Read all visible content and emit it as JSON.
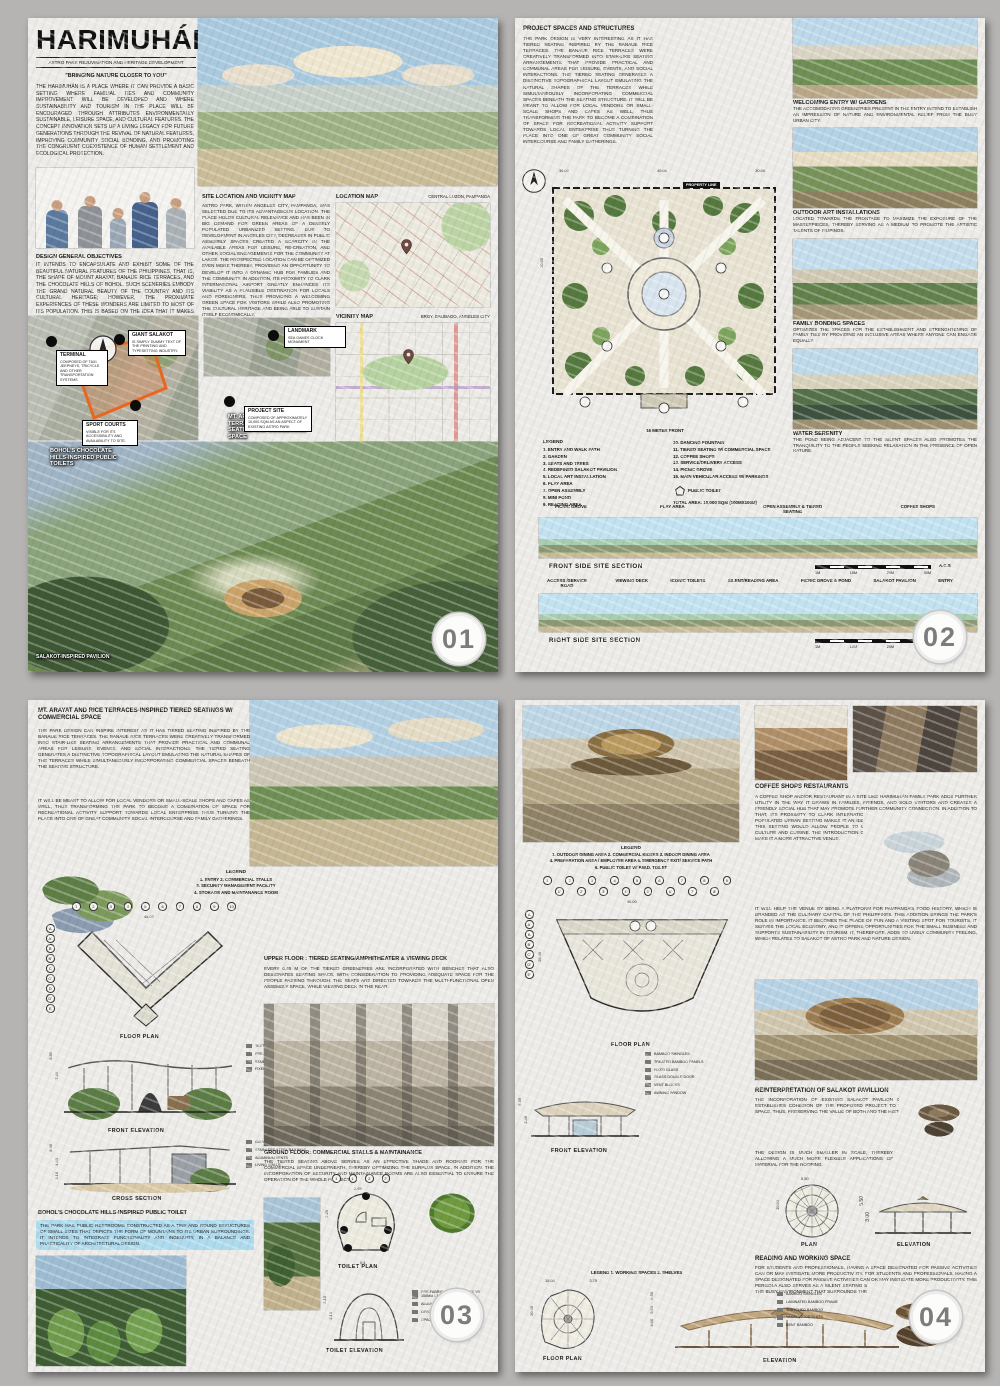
{
  "panel1": {
    "badge": "01",
    "title": "HARIMUHÁN",
    "subtitle": "ASTRO PARK REJUVINATION AND HERITAGE DEVELOPMENT",
    "tagline": "\"BRINGING NATURE CLOSER TO YOU\"",
    "intro": "THE HARIMUHÁN IS A PLACE WHERE IT CAN PROVIDE A BASIC SETTING WHERE FAMILIAL TIES AND COMMUNITY IMPROVEMENT WILL BE DEVELOPED AND WHERE SUSTAINABILITY AND TOURISM IN THE PLACE WILL BE ENCOURAGED THROUGH ATTRIBUTES ENVIRONMENTALLY SUSTAINABLE, LEISURE SPACE, AND CULTURAL FEATURES. THE CONCEPT INNOVATION SETS UP A LIVING LEGACY FOR FUTURE GENERATIONS THROUGH THE REVIVAL OF NATURAL FEATURES, IMPROVING COMMUNITY SOCIAL BONDING, AND PROMOTING THE CONGRUENT COEXISTENCE OF HUMAN SETTLEMENT AND ECOLOGICAL PROTECTION.",
    "objectives_heading": "DESIGN GENERAL OBJECTIVES",
    "objectives": "IT INTENDS TO ENCAPSULATE AND EXHIBIT SOME OF THE BEAUTIFUL NATURAL FEATURES OF THE PHILIPPINES, THAT IS, THE SHAPE OF MOUNT ARAYAT, BANAUE RICE TERRACES, AND THE CHOCOLATE HILLS OF BOHOL. SUCH SCENERIES EMBODY THE GRAND NATURAL BEAUTY OF THE COUNTRY AND ITS CULTURAL HERITAGE; HOWEVER, THE PROXIMATE EXPERIENCES OF THESE WONDERS ARE LIMITED TO MOST OF ITS POPULATION. THIS IS BASED ON THE IDEA THAT IT MAKES THESE UNIQUE CHARACTERISTICS ACCESSIBLE TO THE COMMUNITY SO AS TO ESTABLISH AN ENVIRONMENT EMBODYING THE UNIQUE FORMS AND NATURAL",
    "site_heading": "SITE LOCATION AND VICINITY MAP",
    "site_text": "ASTRO PARK, WITHIN ANGELES CITY, PAMPANGA, WAS SELECTED DUE TO ITS ADVANTAGEOUS LOCATION. THE PLACE HOLDS CULTURAL RELEVANCE AND HAS BEEN IN BIG DEMAND FOR GREEN AREAS OF A DENSELY POPULATED URBANIZED SETTING. DUE TO DEVELOPMENT IN ANGELES CITY, DECREASES IN PUBLIC ASSEMBLY SPACES CREATED A SCARCITY IN THE AVAILABLE AREAS FOR LEISURE, RE-CREATION, AND OTHER SOCIAL ENGAGEMENTS FOR THE COMMUNITY AT LARGE. THE PROSPECTED LOCATION CAN BE OPTIMIZED EVEN MORE THEREBY, PROVIDING AN OPPORTUNITY TO DEVELOP IT INTO A DYNAMIC HUB FOR FAMILIES AND THE COMMUNITY. IN ADDITION, ITS PROXIMITY TO CLARK INTERNATIONAL AIRPORT GREATLY ENHANCES ITS VIABILITY AS A PLAUSIBLE DESTINATION FOR LOCALS AND FOREIGNERS, THUS PROVIDING A WELCOMING GREEN SPACE FOR VISITORS WHILE ALSO PROMOTING THE CULTURAL HERITAGE AND BEING ABLE TO SUSTAIN ITSELF ECONOMICALLY.",
    "location_map_label": "LOCATION MAP",
    "location_map_value": "CENTRAL LUZON, PAMPANGA",
    "vicinity_map_label": "VICINITY MAP",
    "vicinity_map_value": "BRGY. BALIBAGO, ANGELES CITY",
    "callouts": {
      "landmark": {
        "t": "LANDMARK",
        "d": "SEA GAMES CLOCK MONUMENT"
      },
      "giant_salakot": {
        "t": "GIANT SALAKOT",
        "d": "IS SIMPLY DUMMY TEXT OF THE PRINTING AND TYPESETTING INDUSTRY."
      },
      "terminal": {
        "t": "TERMINAL",
        "d": "COMPOSED OF TAXI, JEEPNEYS, TRICYCLE AND OTHER TRANSPORTATION SYSTEMS"
      },
      "project_site": {
        "t": "PROJECT SITE",
        "d": "COMPOSED OF APPROXIMATELY 10,000 SQM AS AN ASPECT OF EXISTING ASTRO PARK"
      },
      "sport_courts": {
        "t": "SPORT COURTS",
        "d": "VISIBLE FOR ITS ACCESSIBILITY AND AVAILABILITY TO SITE."
      }
    },
    "overlay_labels": {
      "seating": "MT. ARAYAT AND RICE TERRACES-INSPIRED SEATING AND COMMERCIAL SPACE",
      "toilets": "BOHOL'S CHOCOLATE HILLS-INSPIRED PUBLIC TOILETS",
      "pavilion": "SALAKOT-INSPIRED PAVILION"
    }
  },
  "panel2": {
    "badge": "02",
    "heading": "PROJECT SPACES AND STRUCTURES",
    "body": "THE PARK DESIGN IS VERY INTERESTING AS IT HAS TIERED SEATING INSPIRED BY THE BANAUE RICE TERRACES. THE BANAUE RICE TERRACES WERE CREATIVELY TRANSFORMED INTO STAIR-LIKE SEATING ARRANGEMENTS THAT PROVIDE PRACTICAL AND COMMUNAL AREAS FOR LEISURE, EVENTS, AND SOCIAL INTERACTIONS. THE TIERED SEATING GENERATES A DISTINCTIVE TOPOGRAPHICAL LAYOUT EMULATING THE NATURAL SHAPES OF THE TERRACES WHILE SIMULTANEOUSLY INCORPORATING COMMERCIAL SPACES BENEATH THE SEATING STRUCTURE. IT WILL BE MEANT TO ALLOW FOR LOCAL VENDORS OR SMALL-SCALE SHOPS AND CAFES AS WELL, THUS TRANSFORMING THE PARK TO BECOME A COMBINATION OF SPACE FOR RECREATIONAL ACTIVITY SUPPORT TOWARDS LOCAL ENTERPRISE THUS TURNING THE PLACE INTO ONE OF GREAT COMMUNITY SOCIAL INTERCOURSE AND FAMILY GATHERINGS.",
    "property_line": "PROPERTY LINE",
    "dims_top": [
      "30.00",
      "40.00",
      "30.00"
    ],
    "dim_left": "20.00",
    "frontage": "16 METER FRONT",
    "legend_title": "LEGEND",
    "legend_col1": [
      "1. ENTRY AND WALK PATH",
      "2. GARDEN",
      "3. SEATS AND TREES",
      "4. REDEFINED SALAKOT PAVILION",
      "5. LOCAL ART INSTALLATION",
      "6. PLAY AREA",
      "7. OPEN ASSEMBLY",
      "8. MINI POND",
      "9. READING AREA"
    ],
    "legend_col2": [
      "10. DANCING FOUNTAIN",
      "11. TIERED SEATING W/ COMMERCIAL SPACE",
      "12. COFFEE SHOPS",
      "13. SERVICE/DELIVERY ACCESS",
      "14. PICNIC GROVE",
      "15. MAIN VEHICULAR ACCESS W/ PARKINGS"
    ],
    "legend_toilet": "PUBLIC TOILET",
    "total_area": "TOTAL AREA: 10,000 SQM (100MX100M)",
    "captions": [
      {
        "t": "WELCOMING ENTRY W/ GARDENS",
        "d": "THE ACCOMODATING GREENERIES PRESENT IN THE ENTRY INTEND TO ESTABLISH AN IMPRESSION OF NATURE AND ENVIRONMENTAL RELIEF FROM THE BUSY URBAN CITY."
      },
      {
        "t": "OUTDOOR ART INSTALLATIONS",
        "d": "LOCATED TOWARDS THE FRONTAGE TO MAXIMIZE THE EXPOSURE OF THE MASTERPIECES, THEREBY SERVING AS A MEDIUM TO PROMOTE THE ARTISTIC TALENTS OF FILIPINOS."
      },
      {
        "t": "FAMILY BONDING SPACES",
        "d": "OPTIMIZES THE SPACES FOR THE ESTABLISHMENT AND STRENGHTENING OF FAMILY TIES BY PROVIDING AN INCLUSIVE AREAS WHERE ANYONE CAN ENGAGE EQUALLY."
      },
      {
        "t": "WATER SERENITY",
        "d": "THE POND BEING ADJACENT TO THE SILENT SPACES ALSO PROMOTES THE TRANQUILITY TO THE PEOPLE SEEKING RELAXATION IN THE PRESENCE OF OPEN NATURE."
      }
    ],
    "front_section_labels": [
      "PICNIC GROVE",
      "PLAY AREA",
      "OPEN ASSEMBLY & TIERED SEATING",
      "COFFEE SHOPS"
    ],
    "front_section_caption": "FRONT SIDE SITE SECTION",
    "right_section_labels": [
      "ACCESS /SERVICE ROAD",
      "VIEWING DECK",
      "ICONIC TOILETS",
      "SILENT/READING AREA",
      "PICNIC GROVE & POND",
      "SALAKOT PAVILION",
      "ENTRY"
    ],
    "right_section_caption": "RIGHT SIDE SITE SECTION",
    "scale_labels": [
      "1M",
      "10M",
      "20M",
      "30M"
    ],
    "scale_suffix": "A.C.S"
  },
  "panel3": {
    "badge": "03",
    "heading": "MT. ARAYAT AND RICE TERRACES-INSPIRED TIERED SEATINGS W/ COMMERCIAL SPACE",
    "para1": "THE PARK DESIGN CAN INSPIRE INTEREST AS IT HAS TIERED SEATING INSPIRED BY THE BANAUE RICE TERRACES. THE BANAUE RICE TERRACES WERE CREATIVELY TRANSFORMED INTO STAIR-LIKE SEATING ARRANGEMENTS THAT PROVIDE PRACTICAL AND COMMUNAL AREAS FOR LEISURE, EVENTS, AND SOCIAL INTERACTIONS. THE TIERED SEATING GENERATES A DISTINCTIVE TOPOGRAPHICAL LAYOUT EMULATING THE NATURAL SHAPES OF THE TERRACES WHILE SIMULTANEOUSLY INCORPORATING COMMERCIAL SPACES BENEATH THE SEATING STRUCTURE.",
    "para2": "IT WILL BE MEANT TO ALLOW FOR LOCAL VENDORS OR SMALL-SCALE SHOPS AND CAFES AS WELL, THUS TRANSFORMING THE PARK TO BECOME A COMBINATION OF SPACE FOR RECREATIONAL ACTIVITY SUPPORT TOWARDS LOCAL ENTERPRISE THUS TURNING THE PLACE INTO ONE OF GREAT COMMUNITY SOCIAL INTERCOURSE AND FAMILY GATHERINGS.",
    "legend_title": "LEGEND",
    "legend_lines": [
      "1. ENTRY    2. COMMERCIAL STALLS",
      "3. SECURITY MANAGEMENT FACILITY",
      "4. STORAGE AND MAINTANANCE ROOM"
    ],
    "grid_top": [
      "1",
      "2",
      "3",
      "4",
      "5",
      "6",
      "7",
      "8",
      "9",
      "10"
    ],
    "grid_side": [
      "A",
      "A'",
      "B",
      "B'",
      "C",
      "C'",
      "D",
      "D'",
      "E"
    ],
    "plan_dim": "45.00",
    "floor_plan_label": "FLOOR PLAN",
    "elev_callouts": [
      "TEXTILE MEMBRANE",
      "PRE-FABRICATED REINFORCED CONCRETE",
      "STAINLESS STEEL TEXTILE FRAME",
      "FIXED GLASS"
    ],
    "elev_dims": [
      "8.90",
      "7.40"
    ],
    "front_elevation_label": "FRONT ELEVATION",
    "section_callouts": [
      "GALVANIZED STEEL COLUMN CAPITAL",
      "STAINLESS STEEL RAILINGS",
      "ALUMINUM VENTS",
      "LIVING WALLS"
    ],
    "section_dims": [
      "8.90",
      "4.45",
      "3.10"
    ],
    "cross_section_label": "CROSS SECTION",
    "toilet_heading": "BOHOL'S CHOCOLATE HILLS-INSPIRED PUBLIC TOILET",
    "toilet_text": "THE PARK HAS PUBLIC RESTROOMS CONSTRUCTED AS A TINY AND ROUND STRUCTURES OF SMALL SIZES THAT DEPICTS THE FORM OF MOUNTAINS TO ITS URBAN SURROUNDINGS. IT INTENDS TO INTEGRATE FUNCTIONALITY AND INGENUITY, IN A BALANCE AND PRACTICALITY OF ARCHITECTURAL DESIGN.",
    "upper_heading": "UPPER FLOOR : TIERED SEATING/AMPHITHEATER & VIEWING DECK",
    "upper_text": "EVERY 0.45 M OF THE TIERED GREENERIES ARE INCORPORATED WITH BENCHES THAT ALSO DESIGNATES SEATING SPACE, WITH CONSIDERATION TO PROVIDING ADEQUATE SPACE FOR THE PEOPLE PASSING THROUGH. THE SEATS ARE DIRECTED TOWARDS THE MULTI-FUNCTIONAL OPEN ASSEMBLY SPACE, WHILE VIEWING DECK IN THE REAR.",
    "ground_heading": "GROUND FLOOR: COMMERCIAL STALLS & MAINTAINANCE",
    "ground_text": "THE TIERED SEATING ABOVE SERVES AS AN EFFECTIVE SHADE AND ROOFING FOR THE COMMERCIAL SPACE UNDERNEATH, THEREBY OPTIMIZING THE SURPLUS SPACE. IN ADDITION, THE INCORPORATION OF SECURITY AND MAINTAINANCE ROOMS ARE ALSO ESSENTIAL TO ENSURE THE OPERATION OF THE WHOLE PROJECT.",
    "toilet_plan_label": "TOILET PLAN",
    "toilet_plan_dims": [
      "2.65",
      "2.25",
      "0.4"
    ],
    "toilet_grid": [
      "1",
      "1'",
      "2",
      "2'"
    ],
    "toilet_elev_label": "TOILET ELEVATION",
    "toilet_elev_dims": [
      "3.10",
      "2.10"
    ],
    "toilet_callouts": [
      "PRE-FABRICATED CONCRETE W/ 150MM LAYER OF SOIL",
      "ALUMINUM VENT",
      "OPAQUE GLASS DOOR",
      "OPAQUE FIXED GLASS WINDOW"
    ]
  },
  "panel4": {
    "badge": "04",
    "legend_title": "LEGEND",
    "legend_lines": [
      "1. OUTDOOR DINING AREA      2. COMMERCIAL KIOSKS      3. INDOOR DINING AREA",
      "4. PREPARATION AREA / EMPLOYEE AREA      5. EMERGENCY EXIT/ SERVICE PATH",
      "6. PUBLIC TOILET W/ P.W.D. TOILET"
    ],
    "grid_top1": [
      "1",
      "2",
      "3",
      "4",
      "5",
      "6",
      "7",
      "8",
      "9"
    ],
    "grid_top2": [
      "1'",
      "2'",
      "3'",
      "4'",
      "5'",
      "6'",
      "7'",
      "8'"
    ],
    "grid_side": [
      "A",
      "A'",
      "B",
      "B'",
      "C'",
      "D'",
      "E'"
    ],
    "plan_dim_top": "40.00",
    "plan_dim_left": "25.00",
    "floor_plan_label": "FLOOR PLAN",
    "elev_callouts": [
      "BAMBOO SHINGLES",
      "TREATED BAMBOO PANELS",
      "FIXED GLASS",
      "GLASS DOUBLE DOOR",
      "VENT BLOCKS",
      "AWNING WINDOW"
    ],
    "elev_dims": [
      "5.55",
      "2.45"
    ],
    "front_elevation_label": "FRONT ELEVATION",
    "coffee_heading": "COFFEE SHOPS  RESTAURANTS",
    "coffee_para1": "A COFFEE SHOP AND/OR RESTAURANT IN A SITE LIKE HARIMUHÁN FAMILY PARK ADDS FURTHER UTILITY IN THE WAY IT DRAWS IN FAMILIES, FRIENDS, AND SOLO VISITORS AND CREATES A FRIENDLY SOCIAL HUB THAT MAY PROMOTE FURTHER COMMUNITY CONNECTION. IN ADDITION TO THAT, ITS PROXIMITY TO CLARK INTERNATIONAL AIRPORT AND ITS LOCATION IN A HIGHLY POPULATED URBAN SETTING MAKES IT AN IDEAL PLACE FOR RESIDENTS AND VISITORS ALIKE. THIS SETTING WOULD ALLOW PEOPLE TO UNWIND WHILE INTERACTING WITH THE LOCAL CULTURE AND CUISINE. THE INTRODUCTION OF KAPAMPANGAN DISHES AND FLAVORS WOULD MAKE IT A MORE ATTRACTIVE VENUE.",
    "coffee_para2": "IT WILL HELP THE VENUE BY BEING A PLATFORM FOR PAMPANGA'S FOOD HISTORY, WHICH IS BRANDED AS THE CULINARY CAPITAL OF THE PHILIPPINES. THIS ADDITION BRINGS THE PARK'S ROLE IN IMPORTANCE. IT BECOMES THE PLACE OF FUN AND A VISITING SPOT FOR TOURISTS. IT SERVES THE LOCAL ECONOMY, AND IT OFFERS OPPORTUNITIES FOR THE SMALL BUSINESS AND SUPPORTS SUSTAINABILITY IN TOURISM. IT, THEREFORE, ADDS TO LIVELY COMMUNITY FEELING, WHICH RELATES TO SALAKOT OF ASTRO PARK AND NATURE DESIGN.",
    "salakot_heading": "REINTERPRETATION OF SALAKOT PAVILLION",
    "salakot_para1": "THE INCORPORATION OF EXISTING SALAKOT PAVILION OF THE FORMER ASTRO PARK ESTABLISHES COHESION OF THE PROPOSED PROJECT TO THE PIONEERING RECREATIONAL SPACE, THUS, PRESERVING THE VALUE OF BOTH AND THE HISTORY THAT IT ENCOMPASSES.",
    "salakot_para2": "THE DESIGN IS MUCH SMALLER IN SCALE, THEREBY ALLOWING A MUCH MORE FLEXIBLE APPLICATIONS OF MATERIAL FOR THE ROOFING.",
    "plan_label": "PLAN",
    "elevation_label": "ELEVATION",
    "salakot_plan_dims": [
      "5.50",
      "10.00"
    ],
    "salakot_elev_dims": [
      "5.50",
      "3.00"
    ],
    "reading_heading": "READING AND WORKING SPACE",
    "reading_text": "FOR STUDENTS AND PROFESSIONALS, HAVING A SPACE DESIGNATED FOR PASSIVE ACTIVITIES CAN OR MAY INSTIGATE MORE PRODUCTIV ITY. FOR STUDENTS AND PROFESSIONALS, HAVING A SPACE DESIGNATED FOR PASSIVE ACTIVITIES CAN OR MAY INSTIGATE MORE PRODUCTIVITY. THIS PERGOLA ALSO SERVES AS A SILENT SEATING SPACE FOR PEOPLE SEEKING TO UNWIND FROM THE BUSY ENVIRONMENT THAT SURROUNDS THE URBAN CITY.",
    "pergola_callouts": [
      "BAMBOO SHINGLES",
      "LAMINATED BAMBOO FRAME",
      "THATCHED BAMBOO",
      "YAKAL WOOD SLATS",
      "BENT BAMBOO"
    ],
    "bottom_legend": "LEGEND    1. WORKING SPACES    2. SHELVES",
    "bottom_plan_dims_top": [
      "10.00",
      "3.75"
    ],
    "bottom_plan_dim_left": "20.00",
    "bottom_elev_dims": [
      "6.50",
      "5.00",
      "3.00"
    ],
    "bottom_floor_plan_label": "FLOOR PLAN",
    "bottom_elevation_label": "ELEVATION"
  }
}
